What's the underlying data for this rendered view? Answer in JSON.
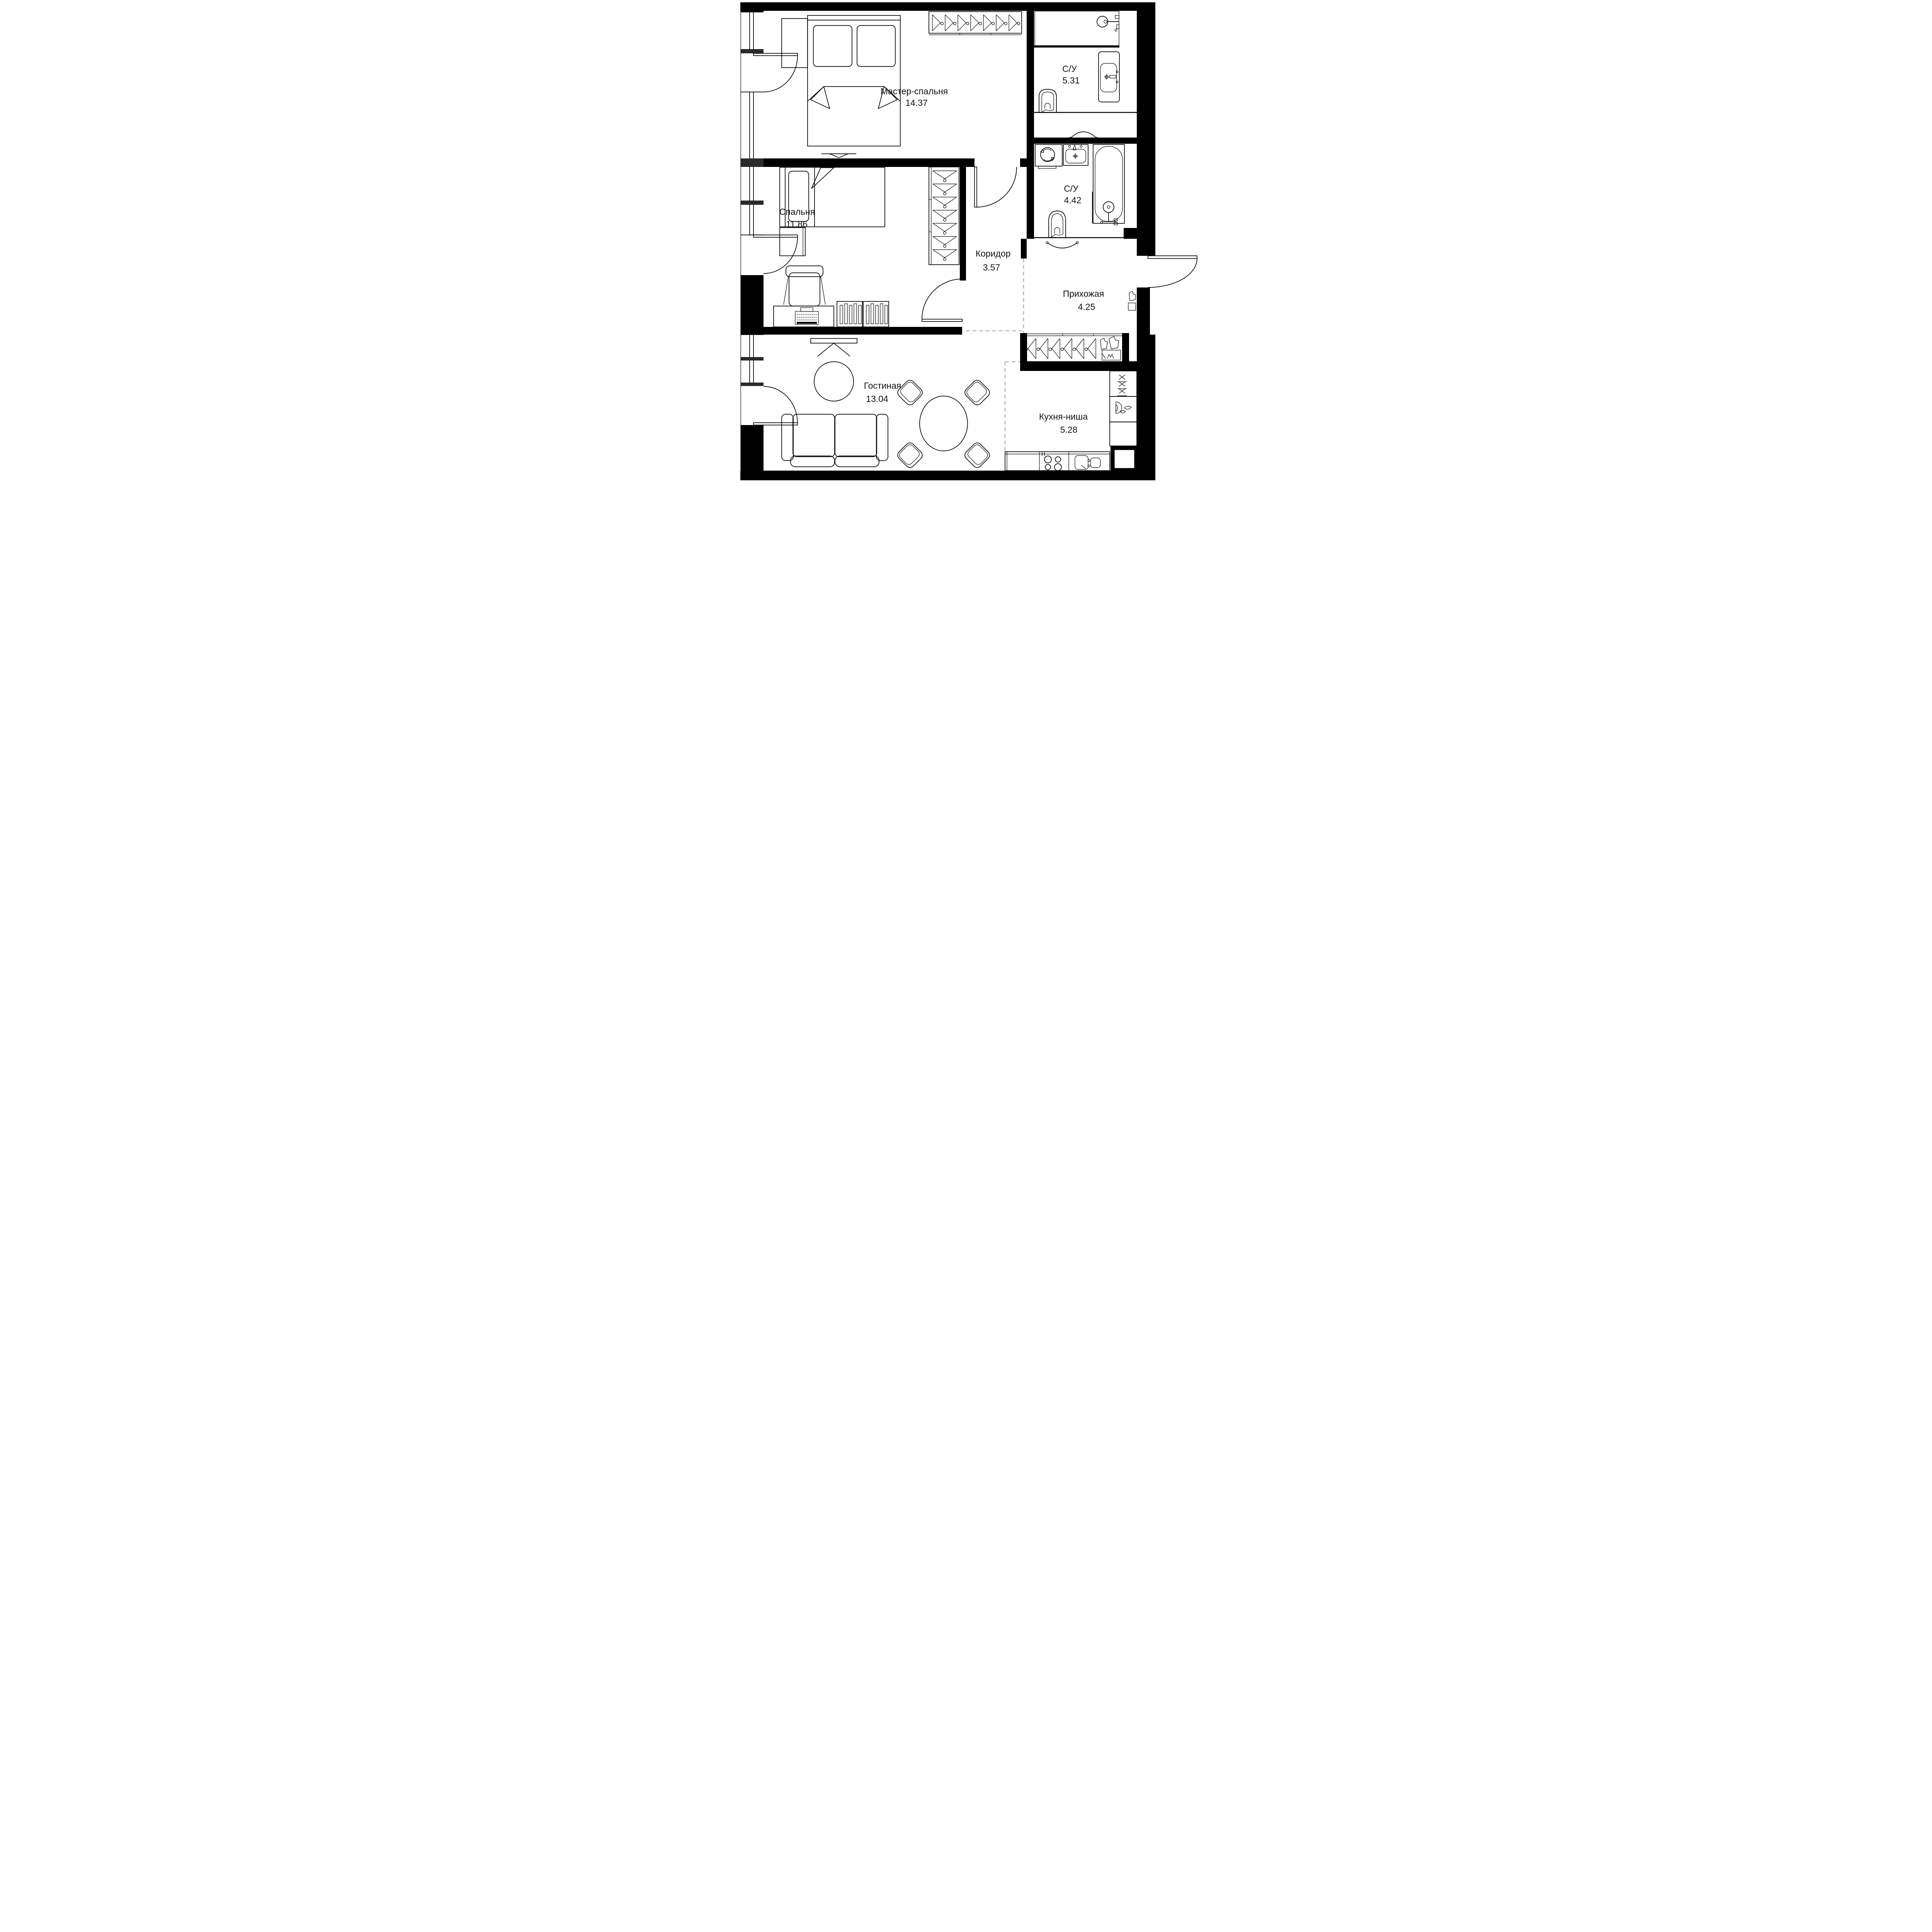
{
  "plan_title": "Apartment floor plan",
  "rooms": [
    {
      "id": "master-bedroom",
      "name": "Мастер-спальня",
      "area": "14.37"
    },
    {
      "id": "bathroom-1",
      "name": "С/У",
      "area": "5.31"
    },
    {
      "id": "bathroom-2",
      "name": "С/У",
      "area": "4.42"
    },
    {
      "id": "bedroom",
      "name": "Спальня",
      "area": "11.86"
    },
    {
      "id": "corridor",
      "name": "Коридор",
      "area": "3.57"
    },
    {
      "id": "hallway",
      "name": "Прихожая",
      "area": "4.25"
    },
    {
      "id": "living-room",
      "name": "Гостиная",
      "area": "13.04"
    },
    {
      "id": "kitchen-niche",
      "name": "Кухня-ниша",
      "area": "5.28"
    }
  ],
  "colors": {
    "walls": "#000000",
    "furniture_lines": "#000000",
    "zone_dashed": "#b4b4b4",
    "background": "#ffffff"
  },
  "icons": {
    "double_bed": "bed with two pillows and folded blanket",
    "single_bed": "bed with pillow and folded blanket",
    "wardrobe_hangers": "row of clothes hangers",
    "shower": "shower head on wall over tray",
    "bathtub": "bathtub with hand shower",
    "vanity_sink": "washbasin with mixer cross",
    "toilet": "toilet bowl",
    "washing_machine": "square with drum and rotation arrows",
    "desk_chair": "office chair at desk",
    "drawer_unit": "slatted drawer cabinet",
    "tv": "wall TV / TV bench",
    "sofa": "three-section sofa with armrests",
    "rug": "round rug",
    "dining_set": "round table with four chairs",
    "stove": "four burner circles",
    "kitchen_sink": "double bowl sink",
    "tall_cabinet": "cabinet with x-marks",
    "entry_door": "outward swing door arc",
    "balcony_door": "inward swing door arc",
    "window": "double glazing line"
  }
}
